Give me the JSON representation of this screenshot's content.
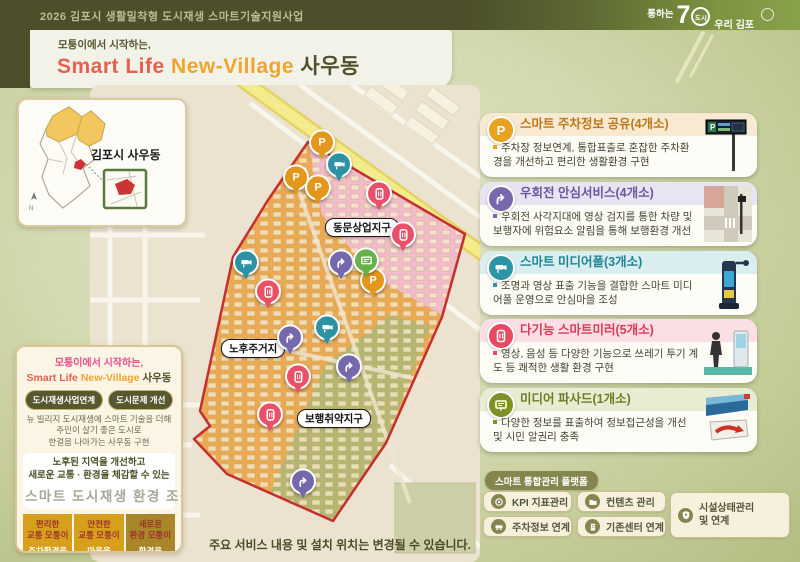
{
  "header": {
    "program_title": "2026 김포시 생활밀착형 도시재생 스마트기술지원사업",
    "logo": {
      "tagline": "통하는",
      "number": "7",
      "circle_text": "도시",
      "name": "우리 김포"
    },
    "subtitle": "모퉁이에서 시작하는,",
    "title_1": "Smart Life",
    "title_2": "New-Village",
    "title_3": "사우동"
  },
  "inset": {
    "label": "김포시 사우동"
  },
  "map": {
    "district_labels": [
      {
        "text": "동문상업지구",
        "x": 140,
        "y": 133
      },
      {
        "text": "노후주거지",
        "x": 36,
        "y": 254
      },
      {
        "text": "보행취약지구",
        "x": 112,
        "y": 324
      }
    ],
    "pin_colors": {
      "parking": "#e3971b",
      "rightturn": "#7668ad",
      "cctv": "#2d93a4",
      "mirror": "#ea5168",
      "facade": "#67b14b"
    },
    "pins": [
      {
        "type": "parking",
        "x": 137,
        "y": 60
      },
      {
        "type": "parking",
        "x": 111,
        "y": 95
      },
      {
        "type": "parking",
        "x": 133,
        "y": 105
      },
      {
        "type": "parking",
        "x": 188,
        "y": 198
      },
      {
        "type": "cctv",
        "x": 154,
        "y": 82
      },
      {
        "type": "cctv",
        "x": 61,
        "y": 180
      },
      {
        "type": "cctv",
        "x": 142,
        "y": 245
      },
      {
        "type": "mirror",
        "x": 194,
        "y": 111
      },
      {
        "type": "mirror",
        "x": 218,
        "y": 152
      },
      {
        "type": "mirror",
        "x": 83,
        "y": 209
      },
      {
        "type": "mirror",
        "x": 113,
        "y": 294
      },
      {
        "type": "mirror",
        "x": 85,
        "y": 332
      },
      {
        "type": "rightturn",
        "x": 156,
        "y": 180
      },
      {
        "type": "rightturn",
        "x": 105,
        "y": 255
      },
      {
        "type": "rightturn",
        "x": 164,
        "y": 284
      },
      {
        "type": "rightturn",
        "x": 118,
        "y": 399
      },
      {
        "type": "facade",
        "x": 181,
        "y": 178
      }
    ]
  },
  "left_panel": {
    "subtitle": "모퉁이에서 시작하는,",
    "title_1": "Smart Life",
    "title_2": "New-Village",
    "title_3": "사우동",
    "buttons": [
      {
        "label": "도시재생사업연계"
      },
      {
        "label": "도시문제 개선"
      }
    ],
    "description": "뉴 빌리지 도시재생에 스마트 기술을 더해\n주민이 살기 좋은 도시로\n한걸음 나아가는 사우동 구현",
    "goal_line1": "노후된 지역을 개선하고",
    "goal_line2": "새로운 교통 · 환경을 체감할 수 있는",
    "goal_highlight": "스마트 도시재생 환경 조성",
    "columns": [
      {
        "top": "편리한\n교통 모퉁이",
        "bottom": "주차환경을\n편리하게"
      },
      {
        "top": "안전한\n교통 모퉁이",
        "bottom": "마을을\n안전하게"
      },
      {
        "top": "새로운\n환경 모퉁이",
        "bottom": "환경을\n새롭게"
      }
    ]
  },
  "services": [
    {
      "title": "스마트 주차정보 공유(4개소)",
      "desc": "주차장 정보연계, 통합표출로 혼잡한 주차환경을 개선하고 편리한 생활환경 구현",
      "accent": "#e8a21f",
      "icon": "parking-icon"
    },
    {
      "title": "우회전 안심서비스(4개소)",
      "desc": "우회전 사각지대에 영상 검지를 통한 차량 및 보행자에 위험요소 알림을 통해 보행환경 개선",
      "accent": "#7a68ae",
      "icon": "right-turn-icon"
    },
    {
      "title": "스마트 미디어폴(3개소)",
      "desc": "조명과 영상 표출 기능을 결합한 스마트 미디어폴 운영으로 안심마을 조성",
      "accent": "#2e93a5",
      "icon": "cctv-icon"
    },
    {
      "title": "다기능 스마트미러(5개소)",
      "desc": "영상, 음성 등 다양한 기능으로 쓰레기 투기 계도 등 쾌적한 생활 환경 구현",
      "accent": "#e84a63",
      "icon": "mirror-icon"
    },
    {
      "title": "미디어 파사드(1개소)",
      "desc": "다양한 정보를 표출하여 정보접근성을 개선 및 시민 알권리 충족",
      "accent": "#7f9029",
      "icon": "display-icon"
    }
  ],
  "platform": {
    "badge": "스마트 통합관리 플랫폼",
    "items": [
      {
        "label": "KPI 지표관리"
      },
      {
        "label": "컨텐츠 관리"
      },
      {
        "label": "주차정보 연계"
      },
      {
        "label": "기존센터 연계"
      },
      {
        "label": "시설상태관리\n및 연계"
      }
    ]
  },
  "footnote": "주요 서비스 내용 및 설치 위치는 변경될 수 있습니다."
}
